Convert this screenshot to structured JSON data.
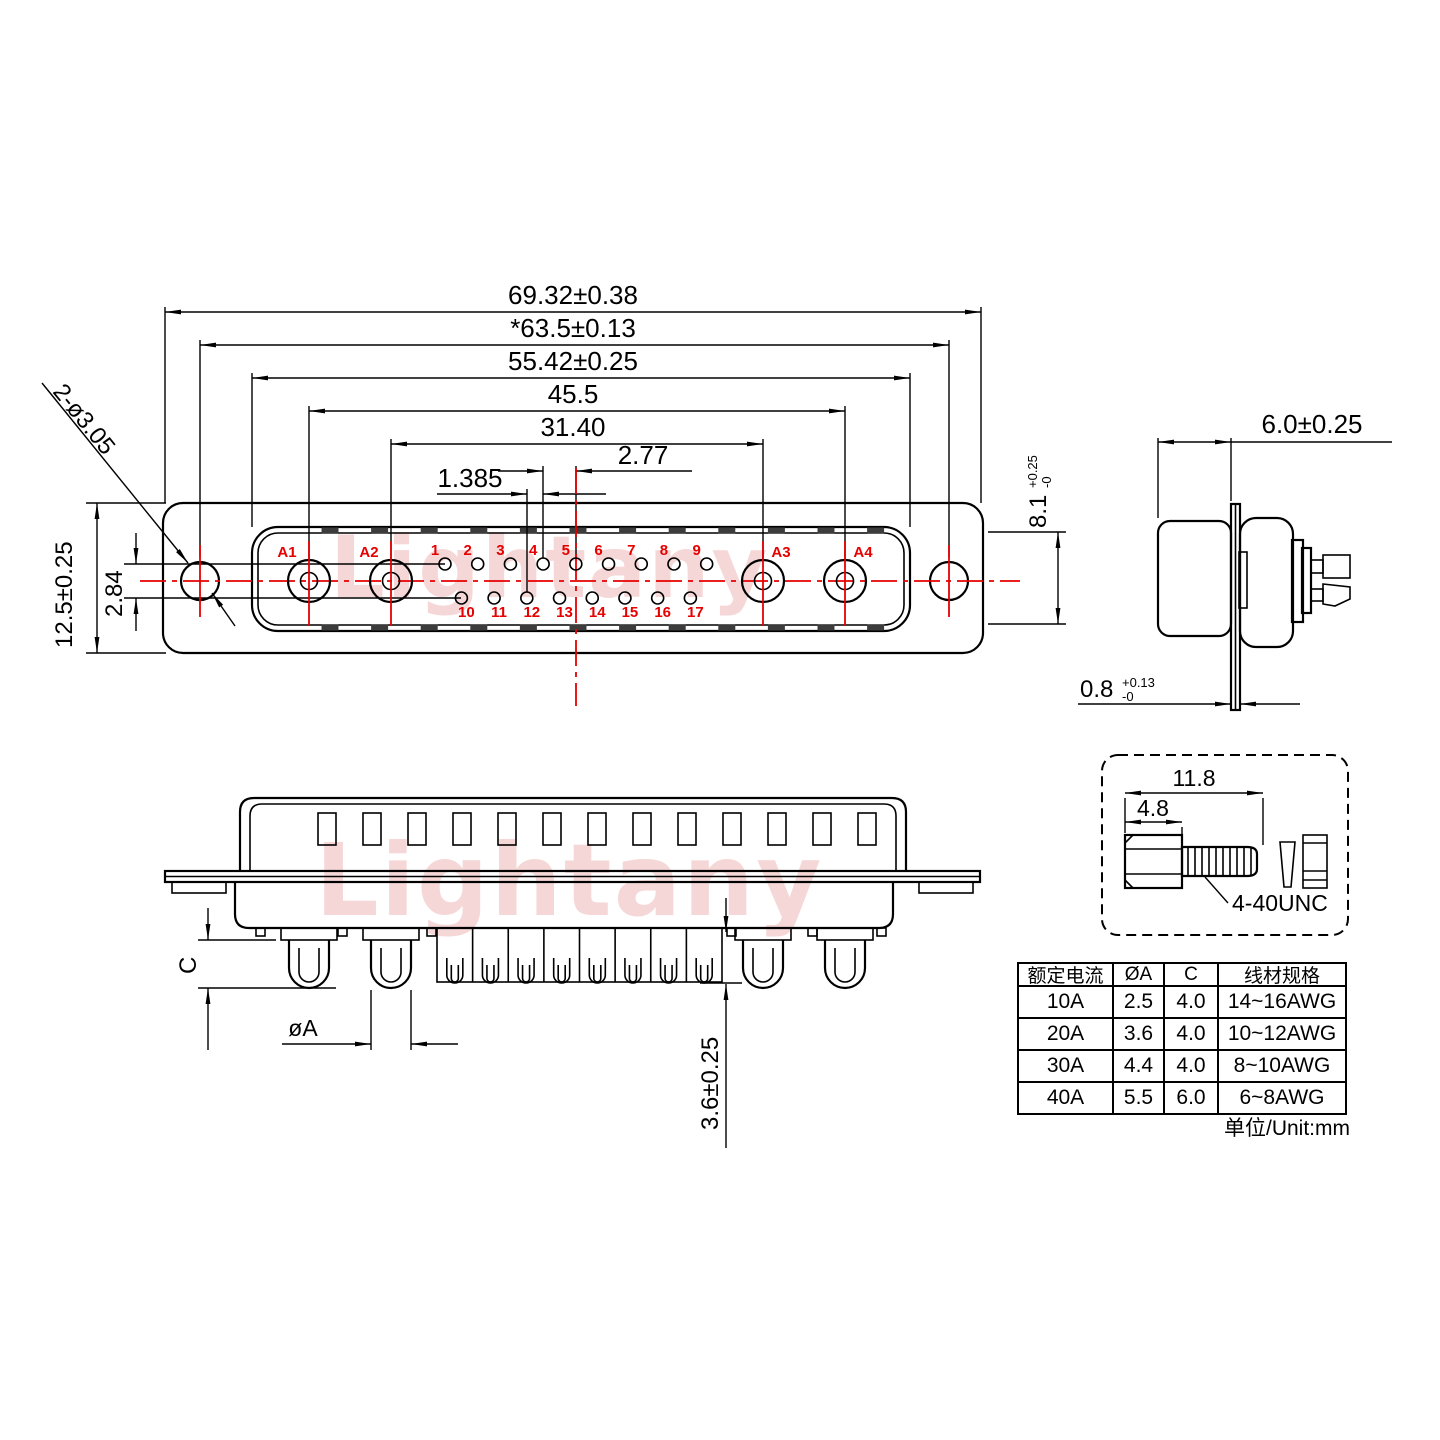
{
  "watermark": {
    "text": "Lightany"
  },
  "front_view": {
    "dims": {
      "overall_width": "69.32±0.38",
      "flange_hole_span": "*63.5±0.13",
      "shroud_width": "55.42±0.25",
      "power_pin_span": "45.5",
      "inner_power_span": "31.40",
      "pin_pitch": "2.77",
      "row_offset": "1.385",
      "body_height": "12.5±0.25",
      "row_gap": "2.84",
      "mount_holes": "2-ø3.05"
    },
    "power_pin_labels": [
      "A1",
      "A2",
      "A3",
      "A4"
    ],
    "top_row_labels": [
      "1",
      "2",
      "3",
      "4",
      "5",
      "6",
      "7",
      "8",
      "9"
    ],
    "bottom_row_labels": [
      "10",
      "11",
      "12",
      "13",
      "14",
      "15",
      "16",
      "17"
    ]
  },
  "side_view": {
    "dims": {
      "shroud_depth": "6.0±0.25",
      "shroud_height": "8.1",
      "shroud_height_tol_plus": "+0.25",
      "shroud_height_tol_minus": "-0",
      "flange_thickness": "0.8",
      "flange_tol_plus": "+0.13",
      "flange_tol_minus": "-0"
    }
  },
  "rear_view": {
    "dims": {
      "pin_length": "C",
      "pin_diameter": "øA",
      "solder_tail": "3.6±0.25"
    }
  },
  "screw_detail": {
    "dims": {
      "total_length": "11.8",
      "head_length": "4.8"
    },
    "thread_label": "4-40UNC"
  },
  "spec_table": {
    "headers": [
      "额定电流",
      "ØA",
      "C",
      "线材规格"
    ],
    "rows": [
      [
        "10A",
        "2.5",
        "4.0",
        "14~16AWG"
      ],
      [
        "20A",
        "3.6",
        "4.0",
        "10~12AWG"
      ],
      [
        "30A",
        "4.4",
        "4.0",
        "8~10AWG"
      ],
      [
        "40A",
        "5.5",
        "6.0",
        "6~8AWG"
      ]
    ],
    "unit_note": "单位/Unit:mm"
  }
}
